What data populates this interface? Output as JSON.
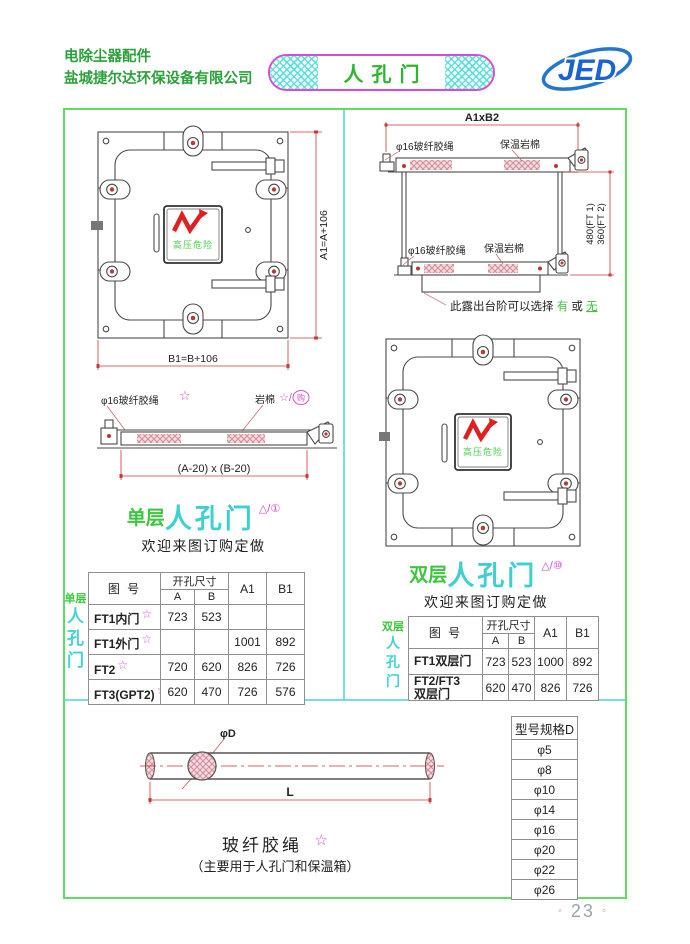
{
  "header": {
    "company_line1": "电除尘器配件",
    "company_line2": "盐城捷尔达环保设备有限公司",
    "badge_title": "人孔门",
    "logo_text": "JED"
  },
  "front_view": {
    "warning_label": "高压危险",
    "dim_height": "A1=A+106",
    "dim_width": "B1=B+106"
  },
  "section_view": {
    "dim_top": "A1xB2",
    "rope_label_top": "φ16玻纤胶绳",
    "wool_label_top": "保温岩棉",
    "rope_label_bottom": "φ16玻纤胶绳",
    "wool_label_bottom": "保温岩棉",
    "dim_side_line1": "480(FT 1)",
    "dim_side_line2": "360(FT 2)",
    "note_prefix": "此露出台阶可以选择",
    "note_option_yes": "有",
    "note_or": "或",
    "note_option_no": "无"
  },
  "single_section_view": {
    "rope_label": "φ16玻纤胶绳",
    "rope_star": "☆",
    "wool_label": "岩棉",
    "wool_mark": "☆/",
    "wool_mark_circled": "购",
    "dim_bottom": "(A-20) x (B-20)"
  },
  "single_door": {
    "title_prefix": "单层",
    "title_main": "人孔门",
    "title_mark": "△/①",
    "subtitle": "欢迎来图订购定做",
    "side_label": "单层",
    "side_char_1": "人",
    "side_char_2": "孔",
    "side_char_3": "门",
    "table": {
      "col_drawing_no": "图  号",
      "col_opening": "开孔尺寸",
      "col_a": "A",
      "col_b": "B",
      "col_a1": "A1",
      "col_b1": "B1",
      "rows": [
        {
          "name": "FT1内门",
          "star": "☆",
          "a": "723",
          "b": "523",
          "a1": "",
          "b1": ""
        },
        {
          "name": "FT1外门",
          "star": "☆",
          "a": "",
          "b": "",
          "a1": "1001",
          "b1": "892"
        },
        {
          "name": "FT2",
          "star": "☆",
          "a": "720",
          "b": "620",
          "a1": "826",
          "b1": "726"
        },
        {
          "name": "FT3(GPT2)",
          "star": "☆",
          "a": "620",
          "b": "470",
          "a1": "726",
          "b1": "576"
        }
      ]
    }
  },
  "double_door": {
    "title_prefix": "双层",
    "title_main": "人孔门",
    "title_mark": "△/⑩",
    "subtitle": "欢迎来图订购定做",
    "side_label": "双层",
    "side_char_1": "人",
    "side_char_2": "孔",
    "side_char_3": "门",
    "table": {
      "col_drawing_no": "图  号",
      "col_opening": "开孔尺寸",
      "col_a": "A",
      "col_b": "B",
      "col_a1": "A1",
      "col_b1": "B1",
      "rows": [
        {
          "name_line1": "FT1双层门",
          "name_line2": "",
          "a": "723",
          "b": "523",
          "a1": "1000",
          "b1": "892"
        },
        {
          "name_line1": "FT2/FT3",
          "name_line2": "双层门",
          "a": "620",
          "b": "470",
          "a1": "826",
          "b1": "726"
        }
      ]
    }
  },
  "rope": {
    "dim_diameter": "φD",
    "dim_length": "L",
    "title": "玻纤胶绳",
    "star": "☆",
    "subtitle": "（主要用于人孔门和保温箱）"
  },
  "spec_table": {
    "header": "型号规格D",
    "rows": [
      "φ5",
      "φ8",
      "φ10",
      "φ14",
      "φ16",
      "φ20",
      "φ22",
      "φ26"
    ]
  },
  "footer": {
    "dot_left": "◦",
    "page_number": "23",
    "dot_right": "◦"
  }
}
